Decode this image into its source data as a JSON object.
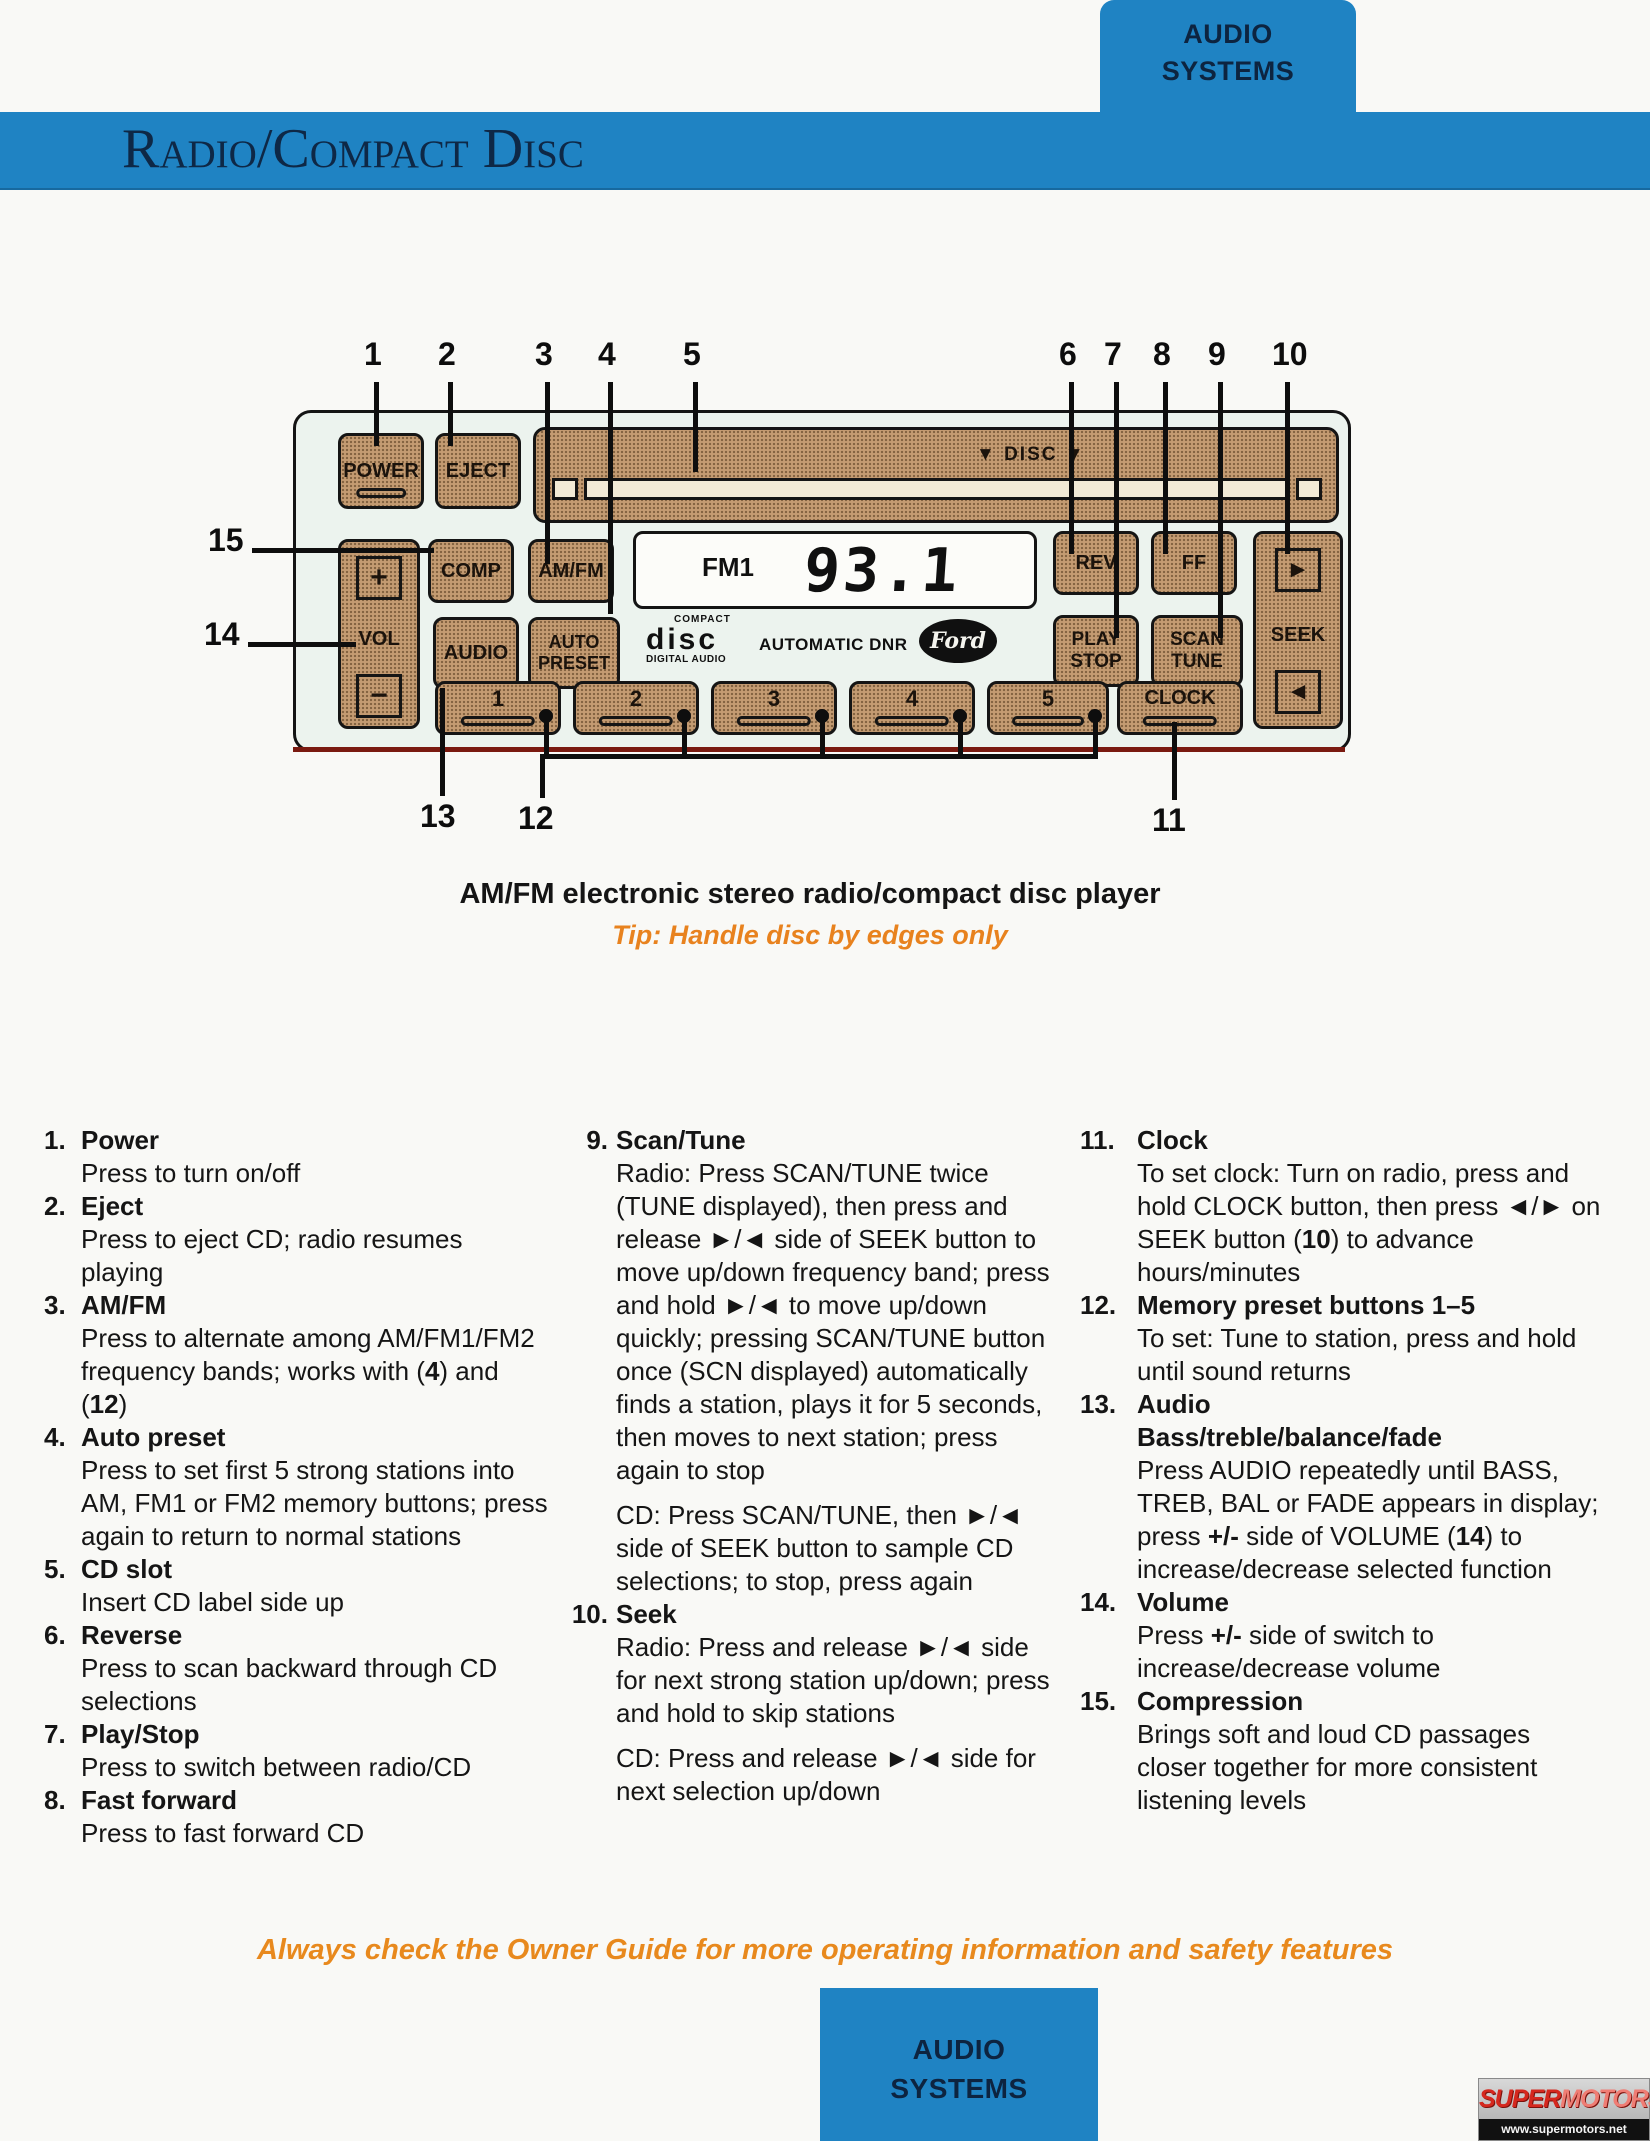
{
  "colors": {
    "accent_blue": "#1f83c3",
    "navy_text": "#0d2440",
    "button_tan": "#c49b72",
    "tip_orange": "#e8821e",
    "footer_orange": "#e8891d",
    "underline_red": "#7a1a10"
  },
  "header": {
    "tab_top": [
      "AUDIO",
      "SYSTEMS"
    ],
    "title": "Radio/Compact Disc"
  },
  "captions": {
    "main": "AM/FM electronic stereo radio/compact disc player",
    "tip": "Tip: Handle disc by edges only"
  },
  "radio": {
    "callouts": [
      "1",
      "2",
      "3",
      "4",
      "5",
      "6",
      "7",
      "8",
      "9",
      "10",
      "11",
      "12",
      "13",
      "14",
      "15"
    ],
    "buttons": {
      "power": "POWER",
      "eject": "EJECT",
      "comp": "COMP",
      "amfm": "AM/FM",
      "audio": "AUDIO",
      "auto_preset": "AUTO\nPRESET",
      "rev": "REV",
      "ff": "FF",
      "play_stop": "PLAY\nSTOP",
      "scan_tune": "SCAN\nTUNE",
      "clock": "CLOCK",
      "vol": "VOL",
      "vol_plus": "+",
      "vol_minus": "−",
      "seek": "SEEK",
      "seek_up": "►",
      "seek_down": "◄",
      "disc_label": "▼ DISC ▼",
      "presets": [
        "1",
        "2",
        "3",
        "4",
        "5"
      ]
    },
    "display": {
      "band": "FM1",
      "frequency": "93.1"
    },
    "branding": {
      "compact": "COMPACT",
      "disc": "disc",
      "digital_audio": "DIGITAL AUDIO",
      "automatic_dnr": "AUTOMATIC DNR",
      "ford": "Ford"
    }
  },
  "legend": {
    "columns": [
      {
        "items": [
          {
            "num": "1.",
            "title": "Power",
            "body": [
              "Press to turn on/off"
            ]
          },
          {
            "num": "2.",
            "title": "Eject",
            "body": [
              "Press to eject CD; radio resumes playing"
            ]
          },
          {
            "num": "3.",
            "title": "AM/FM",
            "body": [
              "Press to alternate among AM/FM1/FM2 frequency bands; works with (**4**) and (**12**)"
            ]
          },
          {
            "num": "4.",
            "title": "Auto preset",
            "body": [
              "Press to set first 5 strong stations into AM, FM1 or FM2 memory buttons; press again to return to normal stations"
            ]
          },
          {
            "num": "5.",
            "title": "CD slot",
            "body": [
              "Insert CD label side up"
            ]
          },
          {
            "num": "6.",
            "title": "Reverse",
            "body": [
              "Press to scan backward through CD selections"
            ]
          },
          {
            "num": "7.",
            "title": "Play/Stop",
            "body": [
              "Press to switch between radio/CD"
            ]
          },
          {
            "num": "8.",
            "title": "Fast forward",
            "body": [
              "Press to fast forward CD"
            ]
          }
        ]
      },
      {
        "items": [
          {
            "num": "9.",
            "title": "Scan/Tune",
            "body": [
              "Radio: Press SCAN/TUNE twice (TUNE displayed), then press and release ►/◄ side of SEEK button to move up/down frequency band; press and hold ►/◄ to move up/down quickly; pressing SCAN/TUNE button once (SCN displayed) automatically finds a station, plays it for 5 seconds, then moves to next station; press again to stop",
              "CD: Press SCAN/TUNE, then ►/◄ side of SEEK button to sample CD selections; to stop, press again"
            ]
          },
          {
            "num": "10.",
            "title": "Seek",
            "body": [
              "Radio: Press and release ►/◄ side for next strong station up/down; press and hold to skip stations",
              "CD: Press and release ►/◄ side for next selection up/down"
            ]
          }
        ]
      },
      {
        "items": [
          {
            "num": "11.",
            "title": "Clock",
            "body": [
              "To set clock: Turn on radio, press and hold CLOCK button, then press ◄/► on SEEK button (**10**) to advance hours/minutes"
            ]
          },
          {
            "num": "12.",
            "title": "Memory preset buttons 1–5",
            "body": [
              "To set: Tune to station, press and hold until sound returns"
            ]
          },
          {
            "num": "13.",
            "title": "Audio\nBass/treble/balance/fade",
            "body": [
              "Press AUDIO repeatedly until BASS, TREB, BAL or FADE appears in display; press **+/-** side of VOLUME (**14**) to increase/decrease selected function"
            ]
          },
          {
            "num": "14.",
            "title": "Volume",
            "body": [
              "Press **+/-** side of switch to increase/decrease volume"
            ]
          },
          {
            "num": "15.",
            "title": "Compression",
            "body": [
              "Brings soft and loud CD passages closer together for more consistent listening levels"
            ]
          }
        ]
      }
    ]
  },
  "footer": {
    "note": "Always check the Owner Guide for more operating information and safety features",
    "tab_bottom": [
      "AUDIO",
      "SYSTEMS"
    ],
    "watermark": {
      "super": "SUPER",
      "motors": "MOTORS",
      "url": "www.supermotors.net"
    }
  }
}
